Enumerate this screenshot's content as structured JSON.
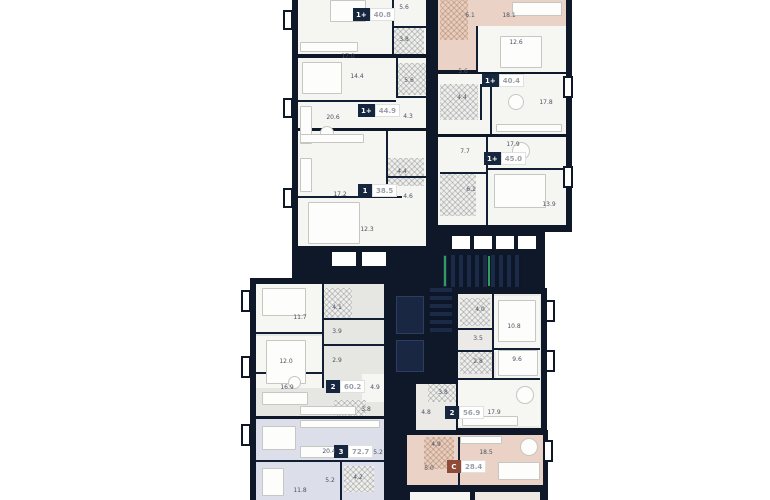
{
  "plan": {
    "title": "residential-floor-plan",
    "colors": {
      "background": "#ffffff",
      "walls": "#0e1828",
      "room_light": "#f5f5f2",
      "room_grey": "#e6e6e2",
      "room_periwinkle": "#dcdfe9",
      "room_salmon": "#ead3c6",
      "badge_bg": "#16263f",
      "badge_studio_bg": "#8f4a38",
      "badge_area_text": "#9aa0a8",
      "room_label_text": "#4a5160",
      "stair_accent": "#2f9e5b"
    },
    "apartments": [
      {
        "id": "apt-1plus-40-8",
        "type": "1+",
        "area": "40.8",
        "rooms": [
          "17.0",
          "5.6",
          "3.8"
        ]
      },
      {
        "id": "apt-1plus-44-9",
        "type": "1+",
        "area": "44.9",
        "rooms": [
          "14.4",
          "5.6",
          "20.6",
          "4.3"
        ]
      },
      {
        "id": "apt-1-38-5",
        "type": "1",
        "area": "38.5",
        "rooms": [
          "17.2",
          "4.4",
          "4.6",
          "12.3"
        ]
      },
      {
        "id": "apt-studio-top",
        "type": "",
        "area": "",
        "rooms": [
          "6.1",
          "18.1"
        ]
      },
      {
        "id": "apt-1plus-40-4",
        "type": "1+",
        "area": "40.4",
        "rooms": [
          "12.6",
          "5.6",
          "4.4",
          "17.8"
        ]
      },
      {
        "id": "apt-1plus-45-0",
        "type": "1+",
        "area": "45.0",
        "rooms": [
          "7.7",
          "17.9",
          "6.1",
          "13.9"
        ]
      },
      {
        "id": "apt-2-60-2",
        "type": "2",
        "area": "60.2",
        "rooms": [
          "11.7",
          "4.1",
          "3.9",
          "12.0",
          "2.9",
          "16.9",
          "4.9",
          "3.8"
        ]
      },
      {
        "id": "apt-3-72-7",
        "type": "3",
        "area": "72.7",
        "rooms": [
          "20.4",
          "5.2",
          "5.2",
          "4.2",
          "11.8"
        ]
      },
      {
        "id": "apt-2-56-9",
        "type": "2",
        "area": "56.9",
        "rooms": [
          "4.0",
          "10.8",
          "3.5",
          "2.8",
          "9.6",
          "3.8",
          "4.8",
          "17.9"
        ]
      },
      {
        "id": "apt-studio-28-4",
        "type": "C",
        "area": "28.4",
        "rooms": [
          "4.9",
          "5.0",
          "18.5"
        ]
      }
    ]
  }
}
